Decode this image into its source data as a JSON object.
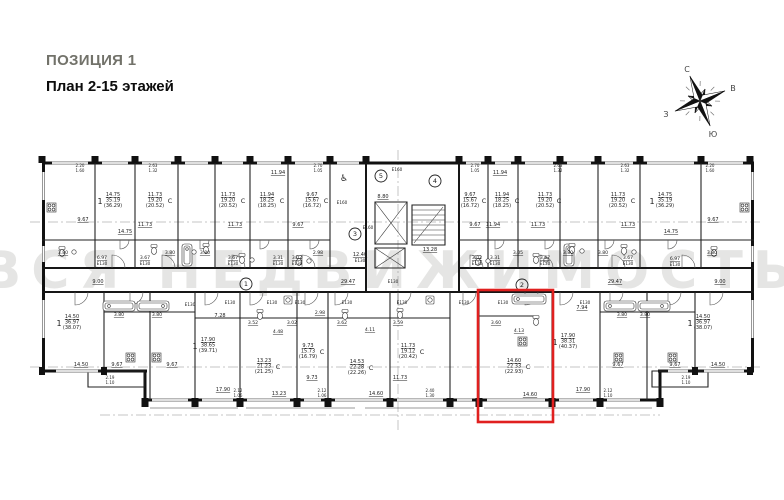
{
  "header": {
    "position": "ПОЗИЦИЯ 1",
    "plan": "План 2-15 этажей"
  },
  "compass": {
    "north": "С",
    "east": "В",
    "south": "Ю",
    "west": "З"
  },
  "watermark": "ВСЯ НЕДВИЖИМОСТЬ",
  "highlight_color": "#e0201f",
  "plan": {
    "unit_badges": [
      {
        "n": "1",
        "x": 246,
        "y": 284
      },
      {
        "n": "2",
        "x": 522,
        "y": 285
      },
      {
        "n": "3",
        "x": 355,
        "y": 234
      },
      {
        "n": "4",
        "x": 435,
        "y": 181
      },
      {
        "n": "5",
        "x": 381,
        "y": 176
      }
    ],
    "labels": [
      {
        "t": "2.20",
        "x": 80,
        "y": 167,
        "s": 4
      },
      {
        "t": "1.60",
        "x": 80,
        "y": 172,
        "s": 4
      },
      {
        "t": "2.63",
        "x": 153,
        "y": 167,
        "s": 4
      },
      {
        "t": "1.32",
        "x": 153,
        "y": 172,
        "s": 4
      },
      {
        "t": "2.70",
        "x": 318,
        "y": 167,
        "s": 4
      },
      {
        "t": "1.05",
        "x": 318,
        "y": 172,
        "s": 4
      },
      {
        "t": "2.70",
        "x": 475,
        "y": 167,
        "s": 4
      },
      {
        "t": "1.05",
        "x": 475,
        "y": 172,
        "s": 4
      },
      {
        "t": "2.63",
        "x": 558,
        "y": 167,
        "s": 4
      },
      {
        "t": "1.32",
        "x": 558,
        "y": 172,
        "s": 4
      },
      {
        "t": "2.63",
        "x": 625,
        "y": 167,
        "s": 4
      },
      {
        "t": "1.32",
        "x": 625,
        "y": 172,
        "s": 4
      },
      {
        "t": "2.20",
        "x": 710,
        "y": 167,
        "s": 4
      },
      {
        "t": "1.60",
        "x": 710,
        "y": 172,
        "s": 4
      },
      {
        "t": "14.75",
        "x": 113,
        "y": 196,
        "u": 1
      },
      {
        "t": "35.19",
        "x": 113,
        "y": 201.5
      },
      {
        "t": "(36.29)",
        "x": 113,
        "y": 207
      },
      {
        "t": "1",
        "x": 100,
        "y": 204,
        "s": 8
      },
      {
        "t": "11.73",
        "x": 155,
        "y": 196,
        "u": 1
      },
      {
        "t": "19.20",
        "x": 155,
        "y": 201.5
      },
      {
        "t": "(20.52)",
        "x": 155,
        "y": 207
      },
      {
        "t": "С",
        "x": 170,
        "y": 203,
        "s": 6.5
      },
      {
        "t": "11.73",
        "x": 228,
        "y": 196,
        "u": 1
      },
      {
        "t": "19.20",
        "x": 228,
        "y": 201.5
      },
      {
        "t": "(20.52)",
        "x": 228,
        "y": 207
      },
      {
        "t": "С",
        "x": 243,
        "y": 203,
        "s": 6.5
      },
      {
        "t": "11.94",
        "x": 267,
        "y": 196,
        "u": 1
      },
      {
        "t": "18.25",
        "x": 267,
        "y": 201.5
      },
      {
        "t": "(18.25)",
        "x": 267,
        "y": 207
      },
      {
        "t": "С",
        "x": 282,
        "y": 203,
        "s": 6.5
      },
      {
        "t": "9.67",
        "x": 312,
        "y": 196,
        "u": 1
      },
      {
        "t": "15.67",
        "x": 312,
        "y": 201.5
      },
      {
        "t": "(16.72)",
        "x": 312,
        "y": 207
      },
      {
        "t": "С",
        "x": 326,
        "y": 203,
        "s": 6.5
      },
      {
        "t": "9.67",
        "x": 470,
        "y": 196,
        "u": 1
      },
      {
        "t": "15.67",
        "x": 470,
        "y": 201.5
      },
      {
        "t": "(16.72)",
        "x": 470,
        "y": 207
      },
      {
        "t": "С",
        "x": 484,
        "y": 203,
        "s": 6.5
      },
      {
        "t": "11.94",
        "x": 502,
        "y": 196,
        "u": 1
      },
      {
        "t": "18.25",
        "x": 502,
        "y": 201.5
      },
      {
        "t": "(18.25)",
        "x": 502,
        "y": 207
      },
      {
        "t": "С",
        "x": 517,
        "y": 203,
        "s": 6.5
      },
      {
        "t": "11.73",
        "x": 545,
        "y": 196,
        "u": 1
      },
      {
        "t": "19.20",
        "x": 545,
        "y": 201.5
      },
      {
        "t": "(20.52)",
        "x": 545,
        "y": 207
      },
      {
        "t": "С",
        "x": 559,
        "y": 203,
        "s": 6.5
      },
      {
        "t": "11.73",
        "x": 618,
        "y": 196,
        "u": 1
      },
      {
        "t": "19.20",
        "x": 618,
        "y": 201.5
      },
      {
        "t": "(20.52)",
        "x": 618,
        "y": 207
      },
      {
        "t": "С",
        "x": 633,
        "y": 203,
        "s": 6.5
      },
      {
        "t": "14.75",
        "x": 665,
        "y": 196,
        "u": 1
      },
      {
        "t": "35.19",
        "x": 665,
        "y": 201.5
      },
      {
        "t": "(36.29)",
        "x": 665,
        "y": 207
      },
      {
        "t": "1",
        "x": 652,
        "y": 204,
        "s": 8
      },
      {
        "t": "9.67",
        "x": 83,
        "y": 221,
        "u": 1
      },
      {
        "t": "14.75",
        "x": 125,
        "y": 233,
        "u": 1
      },
      {
        "t": "11.73",
        "x": 145,
        "y": 226,
        "u": 1
      },
      {
        "t": "11.73",
        "x": 235,
        "y": 226,
        "u": 1
      },
      {
        "t": "11.94",
        "x": 278,
        "y": 174,
        "u": 1
      },
      {
        "t": "9.67",
        "x": 298,
        "y": 226,
        "u": 1
      },
      {
        "t": "9.67",
        "x": 475,
        "y": 226,
        "u": 1
      },
      {
        "t": "11.94",
        "x": 500,
        "y": 174,
        "u": 1
      },
      {
        "t": "11.94",
        "x": 493,
        "y": 226,
        "u": 1
      },
      {
        "t": "11.73",
        "x": 538,
        "y": 226,
        "u": 1
      },
      {
        "t": "11.73",
        "x": 628,
        "y": 226,
        "u": 1
      },
      {
        "t": "14.75",
        "x": 671,
        "y": 233,
        "u": 1
      },
      {
        "t": "9.67",
        "x": 713,
        "y": 221,
        "u": 1
      },
      {
        "t": "3.80",
        "x": 63,
        "y": 254,
        "s": 4.6,
        "u": 1
      },
      {
        "t": "6.97",
        "x": 102,
        "y": 259,
        "s": 4.6,
        "u": 1
      },
      {
        "t": "3.67",
        "x": 145,
        "y": 259,
        "s": 4.6,
        "u": 1
      },
      {
        "t": "3.80",
        "x": 170,
        "y": 254,
        "s": 4.6,
        "u": 1
      },
      {
        "t": "3.80",
        "x": 205,
        "y": 254,
        "s": 4.6,
        "u": 1
      },
      {
        "t": "3.67",
        "x": 233,
        "y": 259,
        "s": 4.6,
        "u": 1
      },
      {
        "t": "3.31",
        "x": 278,
        "y": 259,
        "s": 4.6,
        "u": 1
      },
      {
        "t": "3.02",
        "x": 297,
        "y": 259,
        "s": 4.6,
        "u": 1
      },
      {
        "t": "2.98",
        "x": 318,
        "y": 254,
        "s": 4.6,
        "u": 1
      },
      {
        "t": "3.02",
        "x": 477,
        "y": 259,
        "s": 4.6,
        "u": 1
      },
      {
        "t": "3.31",
        "x": 495,
        "y": 259,
        "s": 4.6,
        "u": 1
      },
      {
        "t": "3.05",
        "x": 518,
        "y": 254,
        "s": 4.6,
        "u": 1
      },
      {
        "t": "3.67",
        "x": 545,
        "y": 259,
        "s": 4.6,
        "u": 1
      },
      {
        "t": "3.80",
        "x": 568,
        "y": 254,
        "s": 4.6,
        "u": 1
      },
      {
        "t": "3.80",
        "x": 603,
        "y": 254,
        "s": 4.6,
        "u": 1
      },
      {
        "t": "3.67",
        "x": 628,
        "y": 259,
        "s": 4.6,
        "u": 1
      },
      {
        "t": "6.97",
        "x": 675,
        "y": 260,
        "s": 4.6,
        "u": 1
      },
      {
        "t": "3.80",
        "x": 712,
        "y": 254,
        "s": 4.6,
        "u": 1
      },
      {
        "t": "E130",
        "x": 102,
        "y": 265,
        "s": 4.2
      },
      {
        "t": "E130",
        "x": 145,
        "y": 265,
        "s": 4.2
      },
      {
        "t": "E130",
        "x": 233,
        "y": 265,
        "s": 4.2
      },
      {
        "t": "E130",
        "x": 278,
        "y": 265,
        "s": 4.2
      },
      {
        "t": "E130",
        "x": 297,
        "y": 265,
        "s": 4.2
      },
      {
        "t": "E130",
        "x": 477,
        "y": 265,
        "s": 4.2
      },
      {
        "t": "E130",
        "x": 495,
        "y": 265,
        "s": 4.2
      },
      {
        "t": "E130",
        "x": 545,
        "y": 265,
        "s": 4.2
      },
      {
        "t": "E130",
        "x": 628,
        "y": 265,
        "s": 4.2
      },
      {
        "t": "E130",
        "x": 675,
        "y": 266,
        "s": 4.2
      },
      {
        "t": "E160",
        "x": 342,
        "y": 204,
        "s": 4.2
      },
      {
        "t": "E160",
        "x": 397,
        "y": 171,
        "s": 4.2
      },
      {
        "t": "E160",
        "x": 368,
        "y": 229,
        "s": 4.2
      },
      {
        "t": "♿",
        "x": 344,
        "y": 181,
        "s": 9
      },
      {
        "t": "8.80",
        "x": 383,
        "y": 198,
        "u": 1
      },
      {
        "t": "13.28",
        "x": 430,
        "y": 251,
        "u": 1
      },
      {
        "t": "12.40",
        "x": 360,
        "y": 256,
        "u": 1
      },
      {
        "t": "E130",
        "x": 360,
        "y": 262,
        "s": 4.2
      },
      {
        "t": "29.47",
        "x": 348,
        "y": 283,
        "u": 1
      },
      {
        "t": "29.47",
        "x": 615,
        "y": 283,
        "u": 1
      },
      {
        "t": "9.00",
        "x": 98,
        "y": 283,
        "u": 1
      },
      {
        "t": "9.00",
        "x": 720,
        "y": 283,
        "u": 1
      },
      {
        "t": "E130",
        "x": 393,
        "y": 283,
        "s": 4.2
      },
      {
        "t": "14.50",
        "x": 72,
        "y": 318,
        "u": 1
      },
      {
        "t": "36.97",
        "x": 72,
        "y": 323.5
      },
      {
        "t": "(38.07)",
        "x": 72,
        "y": 329
      },
      {
        "t": "1",
        "x": 59,
        "y": 326,
        "s": 8
      },
      {
        "t": "17.90",
        "x": 208,
        "y": 341,
        "u": 1
      },
      {
        "t": "38.65",
        "x": 208,
        "y": 346.5
      },
      {
        "t": "(39.71)",
        "x": 208,
        "y": 352
      },
      {
        "t": "1",
        "x": 195,
        "y": 349,
        "s": 8
      },
      {
        "t": "9.73",
        "x": 308,
        "y": 347,
        "u": 1
      },
      {
        "t": "15.73",
        "x": 308,
        "y": 352.5
      },
      {
        "t": "(16.79)",
        "x": 308,
        "y": 358
      },
      {
        "t": "С",
        "x": 322,
        "y": 354,
        "s": 6.5
      },
      {
        "t": "13.23",
        "x": 264,
        "y": 362,
        "u": 1
      },
      {
        "t": "21.23",
        "x": 264,
        "y": 367.5
      },
      {
        "t": "(21.25)",
        "x": 264,
        "y": 373
      },
      {
        "t": "С",
        "x": 278,
        "y": 369,
        "s": 6.5
      },
      {
        "t": "14.53",
        "x": 357,
        "y": 363,
        "u": 1
      },
      {
        "t": "22.28",
        "x": 357,
        "y": 368.5
      },
      {
        "t": "(22.26)",
        "x": 357,
        "y": 374
      },
      {
        "t": "С",
        "x": 371,
        "y": 370,
        "s": 6.5
      },
      {
        "t": "11.73",
        "x": 408,
        "y": 347,
        "u": 1
      },
      {
        "t": "19.12",
        "x": 408,
        "y": 352.5
      },
      {
        "t": "(20.42)",
        "x": 408,
        "y": 358
      },
      {
        "t": "С",
        "x": 422,
        "y": 354,
        "s": 6.5
      },
      {
        "t": "14.60",
        "x": 514,
        "y": 362,
        "u": 1
      },
      {
        "t": "22.33",
        "x": 514,
        "y": 367.5
      },
      {
        "t": "(22.93)",
        "x": 514,
        "y": 373
      },
      {
        "t": "С",
        "x": 528,
        "y": 369,
        "s": 6.5
      },
      {
        "t": "17.90",
        "x": 568,
        "y": 337,
        "u": 1
      },
      {
        "t": "38.31",
        "x": 568,
        "y": 342.5
      },
      {
        "t": "(40.37)",
        "x": 568,
        "y": 348
      },
      {
        "t": "1",
        "x": 555,
        "y": 345,
        "s": 8
      },
      {
        "t": "14.50",
        "x": 703,
        "y": 318,
        "u": 1
      },
      {
        "t": "36.97",
        "x": 703,
        "y": 323.5
      },
      {
        "t": "(38.07)",
        "x": 703,
        "y": 329
      },
      {
        "t": "1",
        "x": 690,
        "y": 326,
        "s": 8
      },
      {
        "t": "14.50",
        "x": 81,
        "y": 366,
        "u": 1
      },
      {
        "t": "9.67",
        "x": 117,
        "y": 366,
        "u": 1
      },
      {
        "t": "9.67",
        "x": 172,
        "y": 366,
        "u": 1
      },
      {
        "t": "7.28",
        "x": 220,
        "y": 317,
        "u": 1
      },
      {
        "t": "17.90",
        "x": 223,
        "y": 391,
        "u": 1
      },
      {
        "t": "3.80",
        "x": 119,
        "y": 316,
        "s": 4.6,
        "u": 1
      },
      {
        "t": "3.80",
        "x": 157,
        "y": 316,
        "s": 4.6,
        "u": 1
      },
      {
        "t": "13.23",
        "x": 279,
        "y": 395,
        "u": 1
      },
      {
        "t": "9.73",
        "x": 312,
        "y": 379,
        "u": 1
      },
      {
        "t": "14.60",
        "x": 376,
        "y": 395,
        "u": 1
      },
      {
        "t": "11.73",
        "x": 400,
        "y": 379,
        "u": 1
      },
      {
        "t": "14.60",
        "x": 530,
        "y": 396,
        "u": 1
      },
      {
        "t": "17.90",
        "x": 583,
        "y": 391,
        "u": 1
      },
      {
        "t": "7.94",
        "x": 582,
        "y": 309,
        "u": 1
      },
      {
        "t": "9.67",
        "x": 618,
        "y": 366,
        "u": 1
      },
      {
        "t": "9.67",
        "x": 675,
        "y": 366,
        "u": 1
      },
      {
        "t": "3.80",
        "x": 622,
        "y": 316,
        "s": 4.6,
        "u": 1
      },
      {
        "t": "3.80",
        "x": 645,
        "y": 316,
        "s": 4.6,
        "u": 1
      },
      {
        "t": "14.50",
        "x": 718,
        "y": 366,
        "u": 1
      },
      {
        "t": "3.52",
        "x": 253,
        "y": 324,
        "s": 4.6,
        "u": 1
      },
      {
        "t": "4.48",
        "x": 278,
        "y": 333,
        "s": 4.6,
        "u": 1
      },
      {
        "t": "3.02",
        "x": 292,
        "y": 324,
        "s": 4.6,
        "u": 1
      },
      {
        "t": "2.98",
        "x": 320,
        "y": 314,
        "s": 4.6,
        "u": 1
      },
      {
        "t": "3.62",
        "x": 342,
        "y": 324,
        "s": 4.6,
        "u": 1
      },
      {
        "t": "4.11",
        "x": 370,
        "y": 331,
        "s": 4.6,
        "u": 1
      },
      {
        "t": "3.59",
        "x": 398,
        "y": 324,
        "s": 4.6,
        "u": 1
      },
      {
        "t": "3.60",
        "x": 496,
        "y": 324,
        "s": 4.6,
        "u": 1
      },
      {
        "t": "4.13",
        "x": 519,
        "y": 332,
        "s": 4.6,
        "u": 1
      },
      {
        "t": "E130",
        "x": 190,
        "y": 306,
        "s": 4.2
      },
      {
        "t": "E130",
        "x": 230,
        "y": 304,
        "s": 4.2
      },
      {
        "t": "E130",
        "x": 272,
        "y": 304,
        "s": 4.2
      },
      {
        "t": "E130",
        "x": 300,
        "y": 304,
        "s": 4.2
      },
      {
        "t": "E130",
        "x": 347,
        "y": 304,
        "s": 4.2
      },
      {
        "t": "E130",
        "x": 402,
        "y": 304,
        "s": 4.2
      },
      {
        "t": "E130",
        "x": 464,
        "y": 304,
        "s": 4.2
      },
      {
        "t": "E130",
        "x": 503,
        "y": 304,
        "s": 4.2
      },
      {
        "t": "E130",
        "x": 585,
        "y": 304,
        "s": 4.2
      },
      {
        "t": "2.19",
        "x": 110,
        "y": 379,
        "s": 4
      },
      {
        "t": "1.10",
        "x": 110,
        "y": 384,
        "s": 4
      },
      {
        "t": "2.12",
        "x": 238,
        "y": 392,
        "s": 4
      },
      {
        "t": "1.06",
        "x": 238,
        "y": 397,
        "s": 4
      },
      {
        "t": "2.12",
        "x": 322,
        "y": 392,
        "s": 4
      },
      {
        "t": "1.06",
        "x": 322,
        "y": 397,
        "s": 4
      },
      {
        "t": "2.40",
        "x": 430,
        "y": 392,
        "s": 4
      },
      {
        "t": "1.30",
        "x": 430,
        "y": 397,
        "s": 4
      },
      {
        "t": "2.12",
        "x": 608,
        "y": 392,
        "s": 4
      },
      {
        "t": "1.10",
        "x": 608,
        "y": 397,
        "s": 4
      },
      {
        "t": "2.19",
        "x": 686,
        "y": 379,
        "s": 4
      },
      {
        "t": "1.10",
        "x": 686,
        "y": 384,
        "s": 4
      }
    ]
  }
}
